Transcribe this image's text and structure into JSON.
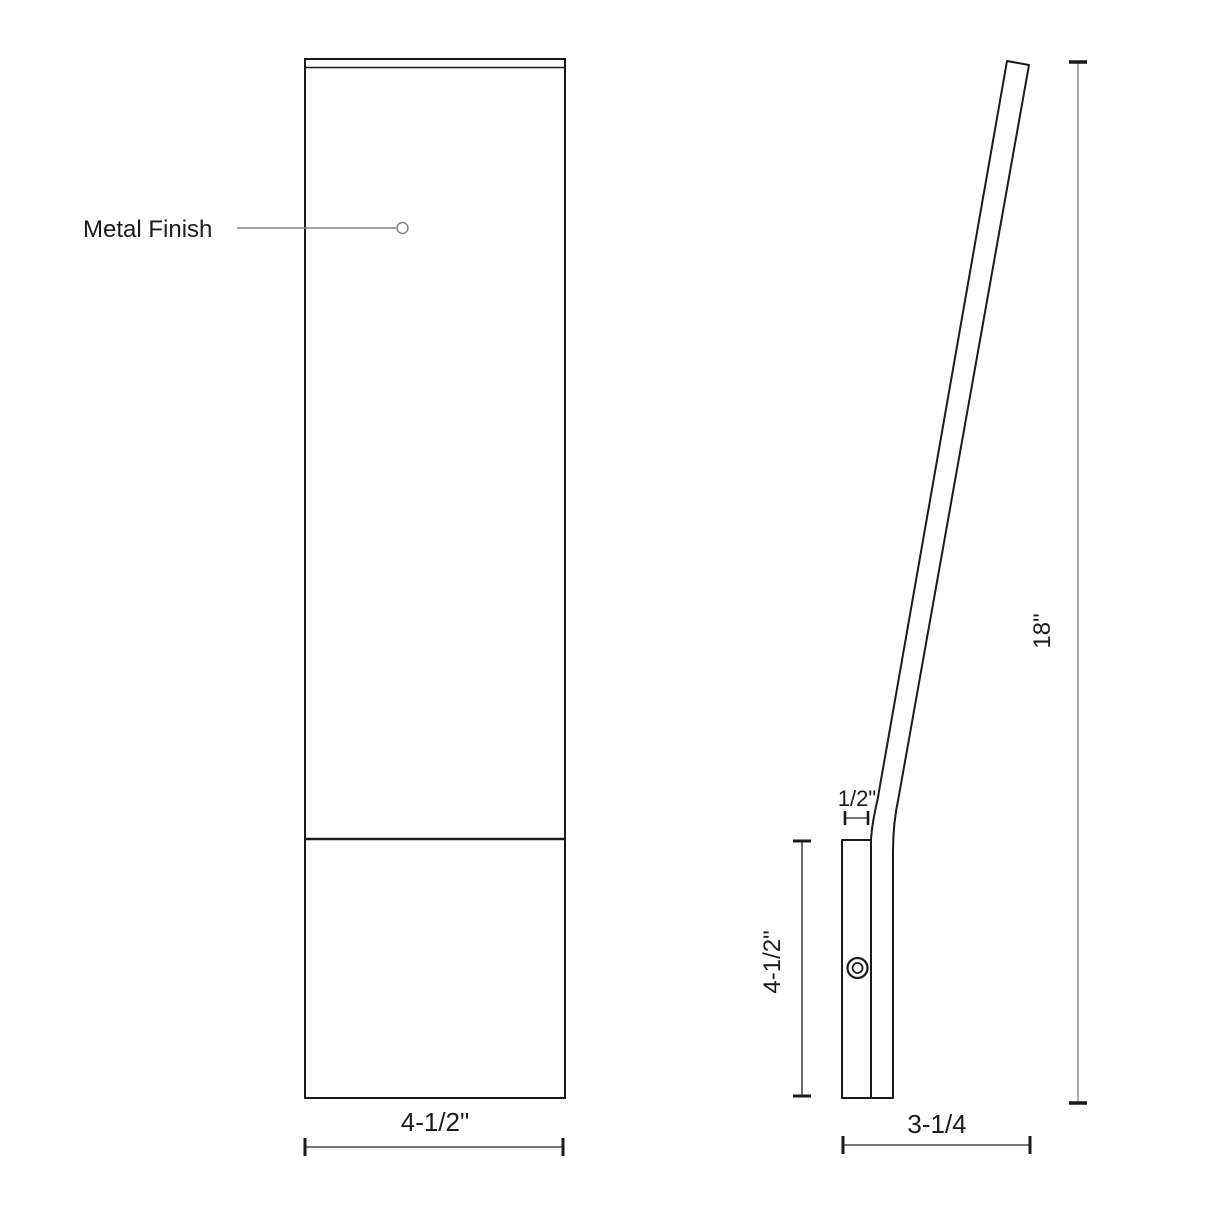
{
  "drawing": {
    "type": "technical-dimension-drawing",
    "views": [
      "front",
      "side-profile"
    ]
  },
  "colors": {
    "background": "#ffffff",
    "object_line": "#1a1a1a",
    "dimension_line": "#4a4a4a",
    "tick": "#1a1a1a",
    "leader_line": "#858585",
    "height_dimension_line": "#919191"
  },
  "front_view": {
    "finish_label": "Metal Finish",
    "width_dim": "4-1/2\""
  },
  "side_view": {
    "thickness_dim": "1/2\"",
    "plate_height_dim": "4-1/2\"",
    "overall_height_dim": "18\"",
    "depth_dim": "3-1/4"
  }
}
